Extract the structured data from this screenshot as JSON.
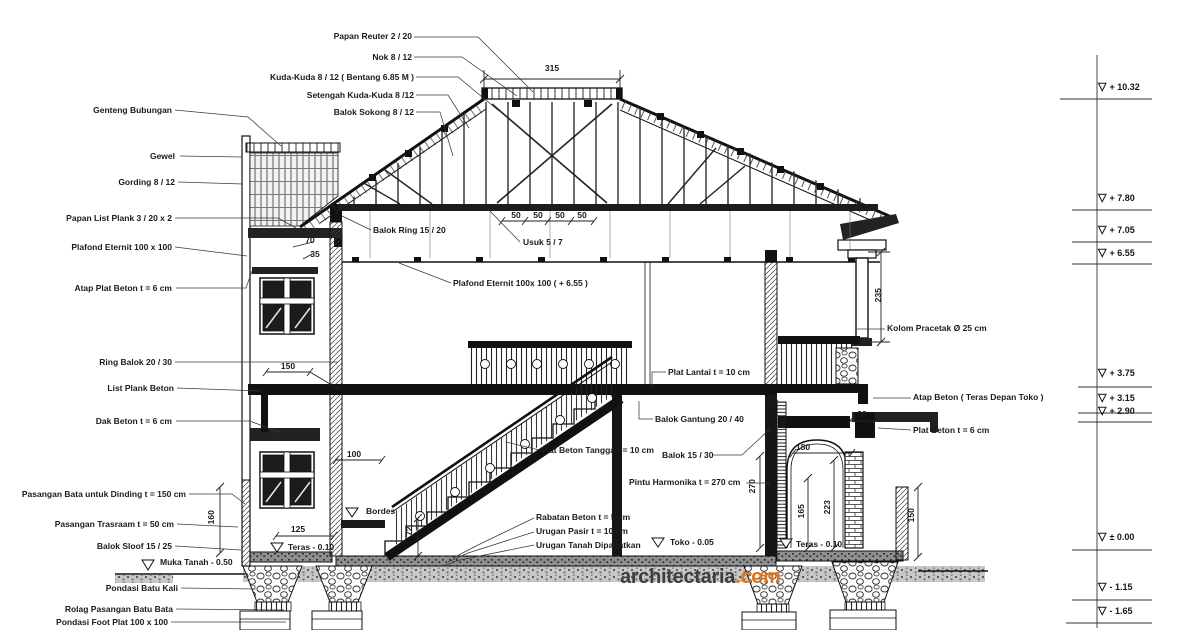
{
  "title": "House cross-section working drawing (potongan rumah)",
  "watermark": {
    "brand": "architectaria",
    "tld": ".com",
    "tld_color": "#e87411",
    "brand_color": "#3e3e3e"
  },
  "labels": {
    "papan_reuter": "Papan Reuter 2 / 20",
    "nok": "Nok 8 / 12",
    "kuda_kuda": "Kuda-Kuda 8 / 12 ( Bentang 6.85 M )",
    "setengah_kuda_kuda": "Setengah Kuda-Kuda 8 /12",
    "balok_sokong": "Balok Sokong 8 / 12",
    "genteng_bubungan": "Genteng Bubungan",
    "gewel": "Gewel",
    "gording": "Gording 8 / 12",
    "papan_list_plank": "Papan List Plank 3 / 20 x 2",
    "plafond_eternit_left": "Plafond Eternit 100 x 100",
    "atap_plat_beton": "Atap Plat Beton t = 6 cm",
    "ring_balok": "Ring Balok 20 / 30",
    "list_plank_beton": "List Plank Beton",
    "dak_beton": "Dak Beton t = 6 cm",
    "pasangan_bata": "Pasangan Bata untuk Dinding t = 150 cm",
    "pasangan_trasraam": "Pasangan Trasraam t = 50 cm",
    "balok_sloof": "Balok Sloof 15 / 25",
    "muka_tanah": "Muka Tanah - 0.50",
    "pondasi_batu_kali": "Pondasi Batu Kali",
    "rolag": "Rolag Pasangan Batu Bata",
    "pondasi_foot_plat": "Pondasi Foot Plat 100 x 100",
    "balok_ring_15_20": "Balok Ring 15 / 20",
    "usuk": "Usuk 5 / 7",
    "plafond_eternit_655": "Plafond Eternit 100x 100 ( + 6.55 )",
    "plat_lantai": "Plat Lantai t = 10 cm",
    "balok_gantung": "Balok Gantung 20 / 40",
    "balok_15_30": "Balok 15 / 30",
    "pintu_harmonika": "Pintu Harmonika t = 270 cm",
    "plat_beton_tangga": "Plat Beton Tangga t = 10 cm",
    "rabatan_beton": "Rabatan Beton t = 5 cm",
    "urugan_pasir": "Urugan Pasir t = 10 cm",
    "urugan_tanah": "Urugan Tanah Dipadatkan",
    "bordes": "Bordes",
    "toko": "Toko - 0.05",
    "teras_left": "Teras - 0.10",
    "teras_right": "Teras - 0.10",
    "atap_beton_teras": "Atap Beton ( Teras Depan Toko )",
    "plat_beton_6": "Plat Beton t = 6 cm",
    "kolom_pracetak": "Kolom Pracetak Ø 25 cm"
  },
  "dims": {
    "w315": "315",
    "w50": "50",
    "w70": "70",
    "w35": "35",
    "w150_left": "150",
    "w100": "100",
    "w125": "125",
    "w180": "180",
    "w30_slab": "30",
    "w30_canopy": "30",
    "h235": "235",
    "h270": "270",
    "h165": "165",
    "h223": "223",
    "h150_right": "150",
    "h72": "72",
    "h160": "160"
  },
  "elevations": [
    "+ 10.32",
    "+ 7.80",
    "+ 7.05",
    "+ 6.55",
    "+ 3.75",
    "+ 3.15",
    "+ 2.90",
    "± 0.00",
    "- 1.15",
    "- 1.65"
  ],
  "marker_glyph": "▽"
}
